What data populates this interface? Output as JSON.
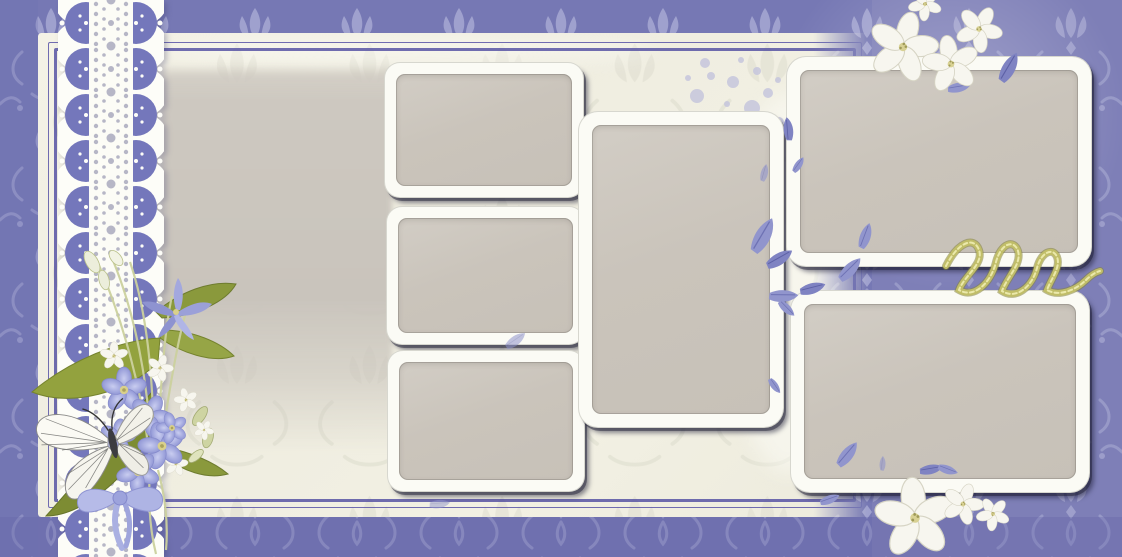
{
  "meta": {
    "page_type": "scrapbook-photo-collage-template",
    "theme": "lavender damask with lace, violets, butterfly and empty photo slots",
    "canvas_width": 1122,
    "canvas_height": 557,
    "visible_text": ""
  },
  "palette": {
    "damask_base": "#7678b4",
    "damask_motif": "#a6a8d2",
    "panel_cream": "#f1efe2",
    "panel_border_purple": "#4f4ba3",
    "photo_slot_fill": "#c9c3ba",
    "frame_white": "#fbfbf5",
    "frame_shadow": "#23233a",
    "lace_white": "#fdfdfa",
    "lace_purple": "#7477bb",
    "ribbon_gold": "#c0bd68",
    "leaf_green": "#8a993c",
    "flower_lavender": "#aab1e3",
    "flower_white": "#f7f6ef",
    "butterfly_white": "#fbfaf4"
  },
  "photo_slots": [
    {
      "id": 1,
      "name": "small landscape photo slot - middle column top"
    },
    {
      "id": 2,
      "name": "small landscape photo slot - middle column center"
    },
    {
      "id": 3,
      "name": "small landscape photo slot - middle column bottom"
    },
    {
      "id": 4,
      "name": "large portrait photo slot - center"
    },
    {
      "id": 5,
      "name": "wide landscape photo slot - top right"
    },
    {
      "id": 6,
      "name": "wide landscape photo slot - bottom right"
    },
    {
      "id": 7,
      "name": "soft-edged photo mat - left of middle column"
    }
  ],
  "decorations": [
    {
      "name": "white-lace-ribbon",
      "position": "left vertical band"
    },
    {
      "name": "violet-bouquet-with-butterfly",
      "position": "left, over lace"
    },
    {
      "name": "white-blossoms",
      "position": "top-right frame edge"
    },
    {
      "name": "white-blossoms",
      "position": "below bottom-right frame"
    },
    {
      "name": "gold-curled-ribbon",
      "position": "between right-hand frames"
    },
    {
      "name": "lavender-leaf-scatter",
      "position": "around center and right frames"
    },
    {
      "name": "lavender-polka-dots",
      "position": "cream area above center frame"
    }
  ]
}
